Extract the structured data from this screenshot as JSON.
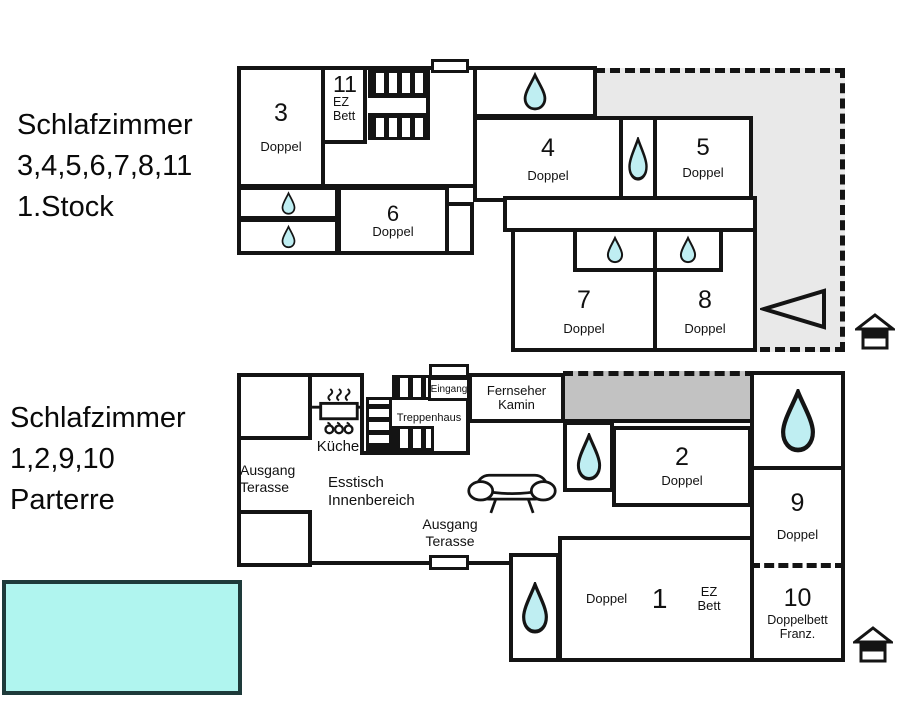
{
  "colors": {
    "wall": "#141414",
    "water": "#bfeef2",
    "pool": "#b0f5ef",
    "pool_border": "#1e3a3a",
    "terrace": "#e9e9e9",
    "covered": "#c2c2c2"
  },
  "icons": {
    "water-drop": "teardrop shape = shower/bath",
    "house": "small house marker",
    "sofa": "sofa outline",
    "stove": "cooking pot with steam and flames",
    "direction-triangle": "left-pointing open triangle",
    "stairs": "hatched stair flights",
    "window": "white wall opening"
  },
  "floor1": {
    "heading": {
      "l1": "Schlafzimmer",
      "l2": "3,4,5,6,7,8,11",
      "l3": "1.Stock"
    },
    "room3": {
      "num": "3",
      "type": "Doppel"
    },
    "room11": {
      "num": "11",
      "type": "EZ Bett"
    },
    "room4": {
      "num": "4",
      "type": "Doppel"
    },
    "room5": {
      "num": "5",
      "type": "Doppel"
    },
    "room6": {
      "num": "6",
      "type": "Doppel"
    },
    "room7": {
      "num": "7",
      "type": "Doppel"
    },
    "room8": {
      "num": "8",
      "type": "Doppel"
    }
  },
  "floor0": {
    "heading": {
      "l1": "Schlafzimmer",
      "l2": "1,2,9,10",
      "l3": "Parterre"
    },
    "kitchen": "Küche",
    "entrance": "Eingang",
    "stairwell": "Treppenhaus",
    "tv": {
      "l1": "Fernseher",
      "l2": "Kamin"
    },
    "exit_terrace_left": {
      "l1": "Ausgang",
      "l2": "Terasse"
    },
    "dining": {
      "l1": "Esstisch",
      "l2": "Innenbereich"
    },
    "exit_terrace_bottom": {
      "l1": "Ausgang",
      "l2": "Terasse"
    },
    "room1": {
      "num": "1",
      "left": "Doppel",
      "right": "EZ Bett"
    },
    "room2": {
      "num": "2",
      "type": "Doppel"
    },
    "room9": {
      "num": "9",
      "type": "Doppel"
    },
    "room10": {
      "num": "10",
      "type1": "Doppelbett",
      "type2": "Franz."
    }
  }
}
